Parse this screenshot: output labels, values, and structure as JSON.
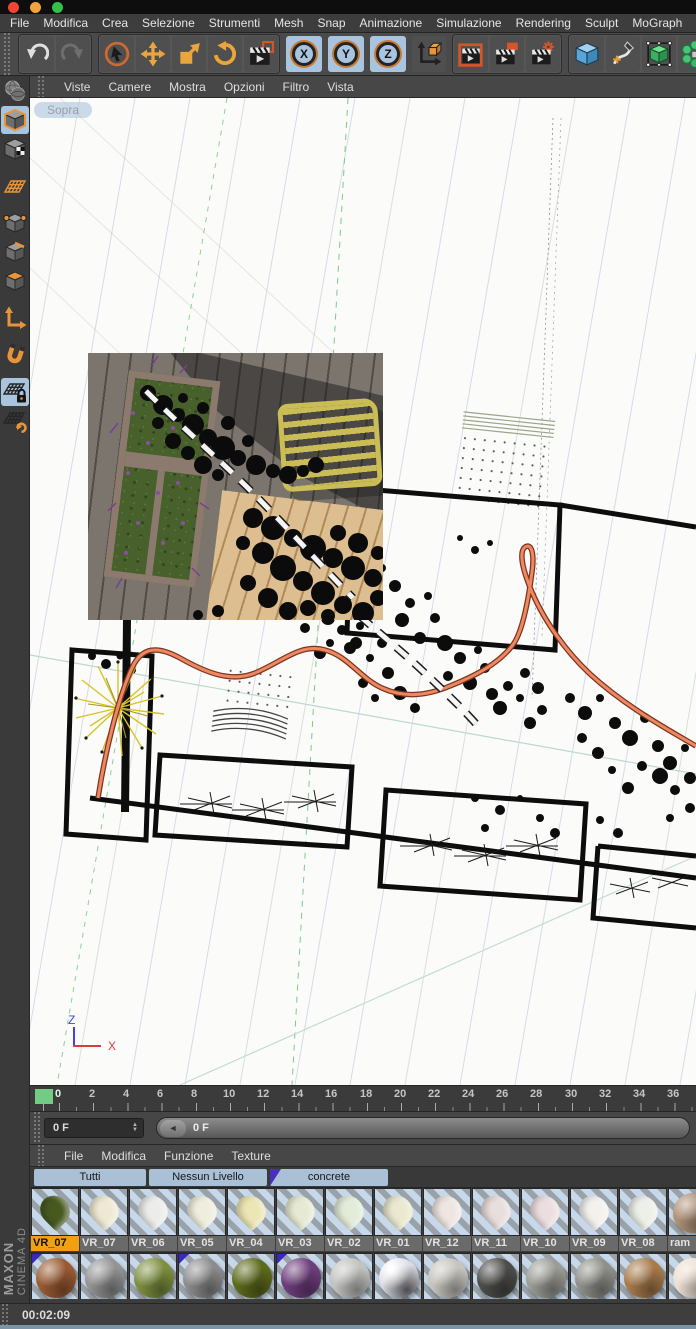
{
  "menu_bar": {
    "items": [
      "File",
      "Modifica",
      "Crea",
      "Selezione",
      "Strumenti",
      "Mesh",
      "Snap",
      "Animazione",
      "Simulazione",
      "Rendering",
      "Sculpt",
      "MoGraph",
      "Pe"
    ]
  },
  "toolbar": {
    "axis": [
      "X",
      "Y",
      "Z"
    ],
    "icons": [
      "undo",
      "redo",
      "live-selection",
      "move",
      "scale",
      "rotate",
      "record-keyframe",
      "axis-x-lock",
      "axis-y-lock",
      "axis-z-lock",
      "coordinate-system",
      "render-view",
      "render-picture-viewer",
      "render-settings",
      "add-cube",
      "add-spline",
      "subdivision-surface",
      "array-clone"
    ]
  },
  "viewport": {
    "menu": [
      "Viste",
      "Camere",
      "Mostra",
      "Opzioni",
      "Filtro",
      "Vista"
    ],
    "view_label": "Sopra",
    "axis_indicator": {
      "up": "Z",
      "right": "X"
    },
    "colors": {
      "spline_orange": "#ee8860",
      "grid_blue": "#d3dce6",
      "grid_green": "#7cc98a",
      "axis_z": "#4444dd",
      "axis_x": "#d83c3c",
      "geometry_black": "#0d0d0d",
      "tree_yellow": "#d8c22a"
    }
  },
  "left_toolbar": {
    "items": [
      "make-editable",
      "model-mode",
      "texture-mode",
      "workplane-mode",
      "points-mode",
      "edges-mode",
      "polygons-mode",
      "axis-mode",
      "snapping",
      "lock-workplane",
      "workplane-rotate"
    ],
    "selected": [
      "model-mode",
      "lock-workplane"
    ]
  },
  "timeline": {
    "tick_labels": [
      "0",
      "2",
      "4",
      "6",
      "8",
      "10",
      "12",
      "14",
      "16",
      "18",
      "20",
      "22",
      "24",
      "26",
      "28",
      "30",
      "32",
      "34",
      "36"
    ],
    "playhead_frame": "0",
    "playhead_color": "#72cc84"
  },
  "frame_controls": {
    "field_value": "0 F",
    "slider_value": "0 F",
    "icons": {
      "stepper_up": "▲",
      "stepper_down": "▼",
      "slider_arrow": "◄"
    }
  },
  "material_manager": {
    "menu": [
      "File",
      "Modifica",
      "Funzione",
      "Texture"
    ],
    "layer_tabs": [
      "Tutti",
      "Nessun Livello",
      "concrete"
    ],
    "row1": [
      {
        "label": "VR_07",
        "color": "#47591f",
        "shape": "leaf",
        "selected": true
      },
      {
        "label": "VR_07",
        "color": "#efe9d4",
        "shape": "leaf"
      },
      {
        "label": "VR_06",
        "color": "#ececea",
        "shape": "leaf"
      },
      {
        "label": "VR_05",
        "color": "#efeddd",
        "shape": "leaf"
      },
      {
        "label": "VR_04",
        "color": "#ece5b4",
        "shape": "leaf"
      },
      {
        "label": "VR_03",
        "color": "#e6ead2",
        "shape": "leaf"
      },
      {
        "label": "VR_02",
        "color": "#e2ecd8",
        "shape": "leaf"
      },
      {
        "label": "VR_01",
        "color": "#eae9cf",
        "shape": "leaf"
      },
      {
        "label": "VR_12",
        "color": "#efe6e2",
        "shape": "leaf"
      },
      {
        "label": "VR_11",
        "color": "#e8dedb",
        "shape": "leaf"
      },
      {
        "label": "VR_10",
        "color": "#ecdee0",
        "shape": "leaf"
      },
      {
        "label": "VR_09",
        "color": "#f2f1ee",
        "shape": "leaf"
      },
      {
        "label": "VR_08",
        "color": "#edefe9",
        "shape": "leaf"
      },
      {
        "label": "ram",
        "color": "#ad9075",
        "shape": "sphere"
      }
    ],
    "row2": [
      {
        "color": "#9a5a32",
        "layer_corner": true
      },
      {
        "color": "#939393"
      },
      {
        "color": "#7d8f3e"
      },
      {
        "color": "#8c8c8c",
        "layer_corner": true
      },
      {
        "color": "#5c6a1a"
      },
      {
        "color": "#6e3d7c",
        "layer_corner": true
      },
      {
        "color": "#c2c2c0"
      },
      {
        "color": "#dadae2",
        "chrome": true
      },
      {
        "color": "#c6c4be"
      },
      {
        "color": "#4c4c4a"
      },
      {
        "color": "#9c9c96"
      },
      {
        "color": "#90908a"
      },
      {
        "color": "#a87a4a"
      },
      {
        "color": "#ecdfd2"
      }
    ]
  },
  "status_bar": {
    "time": "00:02:09"
  },
  "branding": {
    "maxon": "MAXON",
    "cinema": "CINEMA 4D"
  }
}
